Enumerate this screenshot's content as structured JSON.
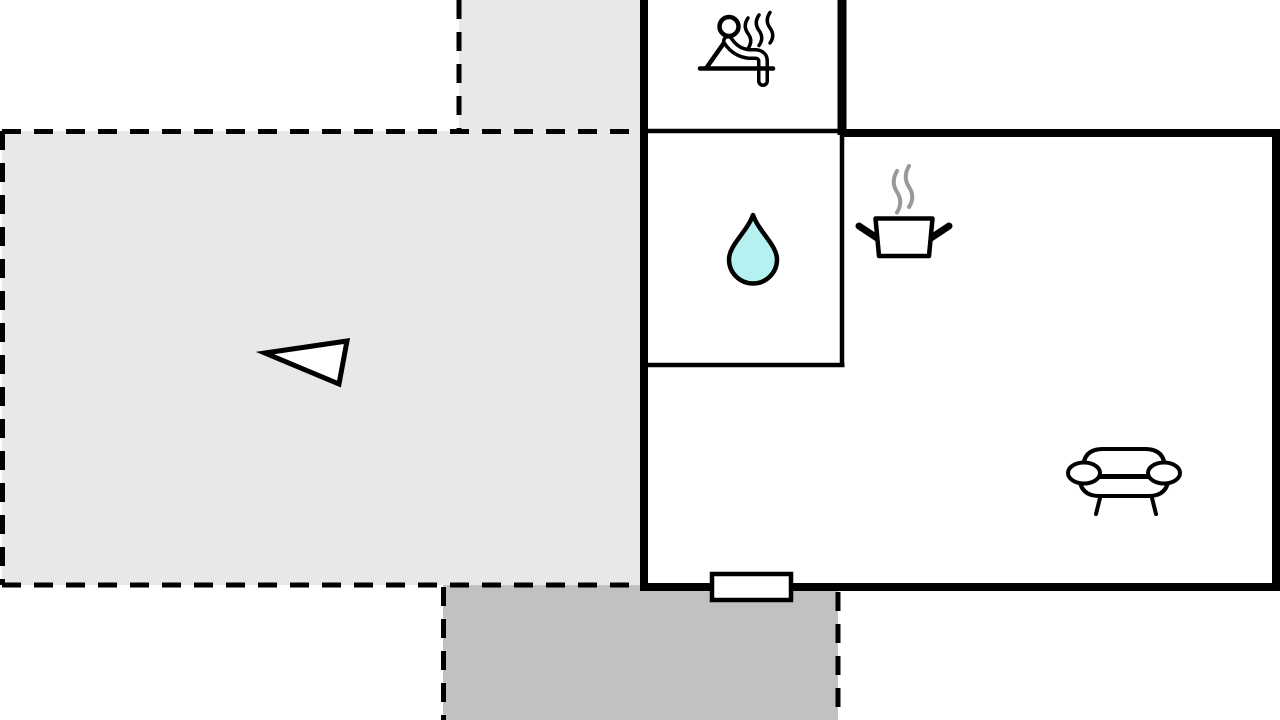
{
  "plan": {
    "kind": "apartment-floor-plan",
    "colors": {
      "background": "#ffffff",
      "wall": "#000000",
      "terrace": "#e8e8e8",
      "patio": "#c1c1c1",
      "room": "#ffffff",
      "water_drop": "#b5f1f1",
      "steam": "#999999",
      "icon": "#000000",
      "white": "#ffffff"
    },
    "rooms": {
      "sauna": {
        "icon": "person-in-sauna"
      },
      "bathroom": {
        "icon": "water-drop"
      },
      "kitchen_living": {
        "icons": [
          "steaming-pot",
          "sofa"
        ]
      },
      "terrace": {
        "icon": "direction-arrow"
      },
      "patio": {
        "icons": []
      }
    },
    "features": {
      "door": "entrance-door"
    }
  }
}
